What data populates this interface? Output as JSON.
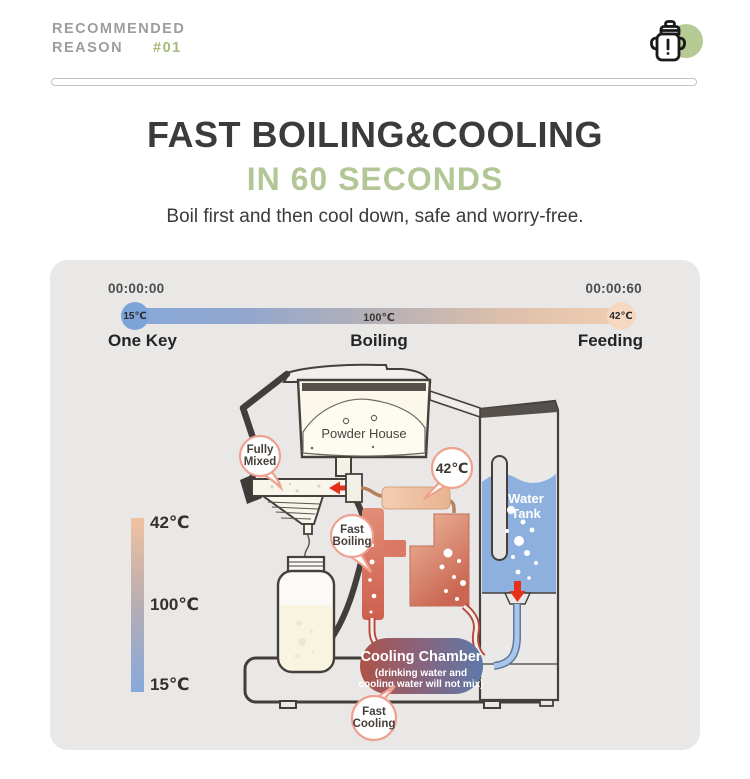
{
  "header": {
    "label_line1": "RECOMMENDED",
    "label_line2": "REASON",
    "badge": "#01",
    "icon": "sippy-cup-icon"
  },
  "hero": {
    "title": "FAST BOILING&COOLING",
    "highlight": "IN 60 SECONDS",
    "description": "Boil first and then cool down, safe and worry-free."
  },
  "timeline": {
    "start_time": "00:00:00",
    "end_time": "00:00:60",
    "start_temp": "15℃",
    "mid_temp": "100℃",
    "end_temp": "42℃",
    "start_label": "One Key",
    "mid_label": "Boiling",
    "end_label": "Feeding"
  },
  "temperature_scale": {
    "top": "42℃",
    "middle": "100℃",
    "bottom": "15℃"
  },
  "diagram": {
    "powder_house": "Powder House",
    "water_tank_line1": "Water",
    "water_tank_line2": "Tank",
    "fully_mixed_line1": "Fully",
    "fully_mixed_line2": "Mixed",
    "outlet_temp": "42℃",
    "fast_boiling_line1": "Fast",
    "fast_boiling_line2": "Boiling",
    "fast_cooling_line1": "Fast",
    "fast_cooling_line2": "Cooling",
    "cooling_chamber_title": "Cooling Chamber",
    "cooling_chamber_note_line1": "(drinking water and",
    "cooling_chamber_note_line2": "cooling water will not mix)"
  },
  "colors": {
    "accent_green": "#b2c795",
    "badge_green": "#a4bb79",
    "panel_bg": "#e9e8e6",
    "cold_blue": "#84a8da",
    "warm_peach": "#f2cfb2",
    "hot_red": "#ce5f4e",
    "tank_blue": "#8db0de",
    "bubble_border": "#efa18f",
    "arrow_red": "#e5301c",
    "outline_dark": "#46403d"
  }
}
